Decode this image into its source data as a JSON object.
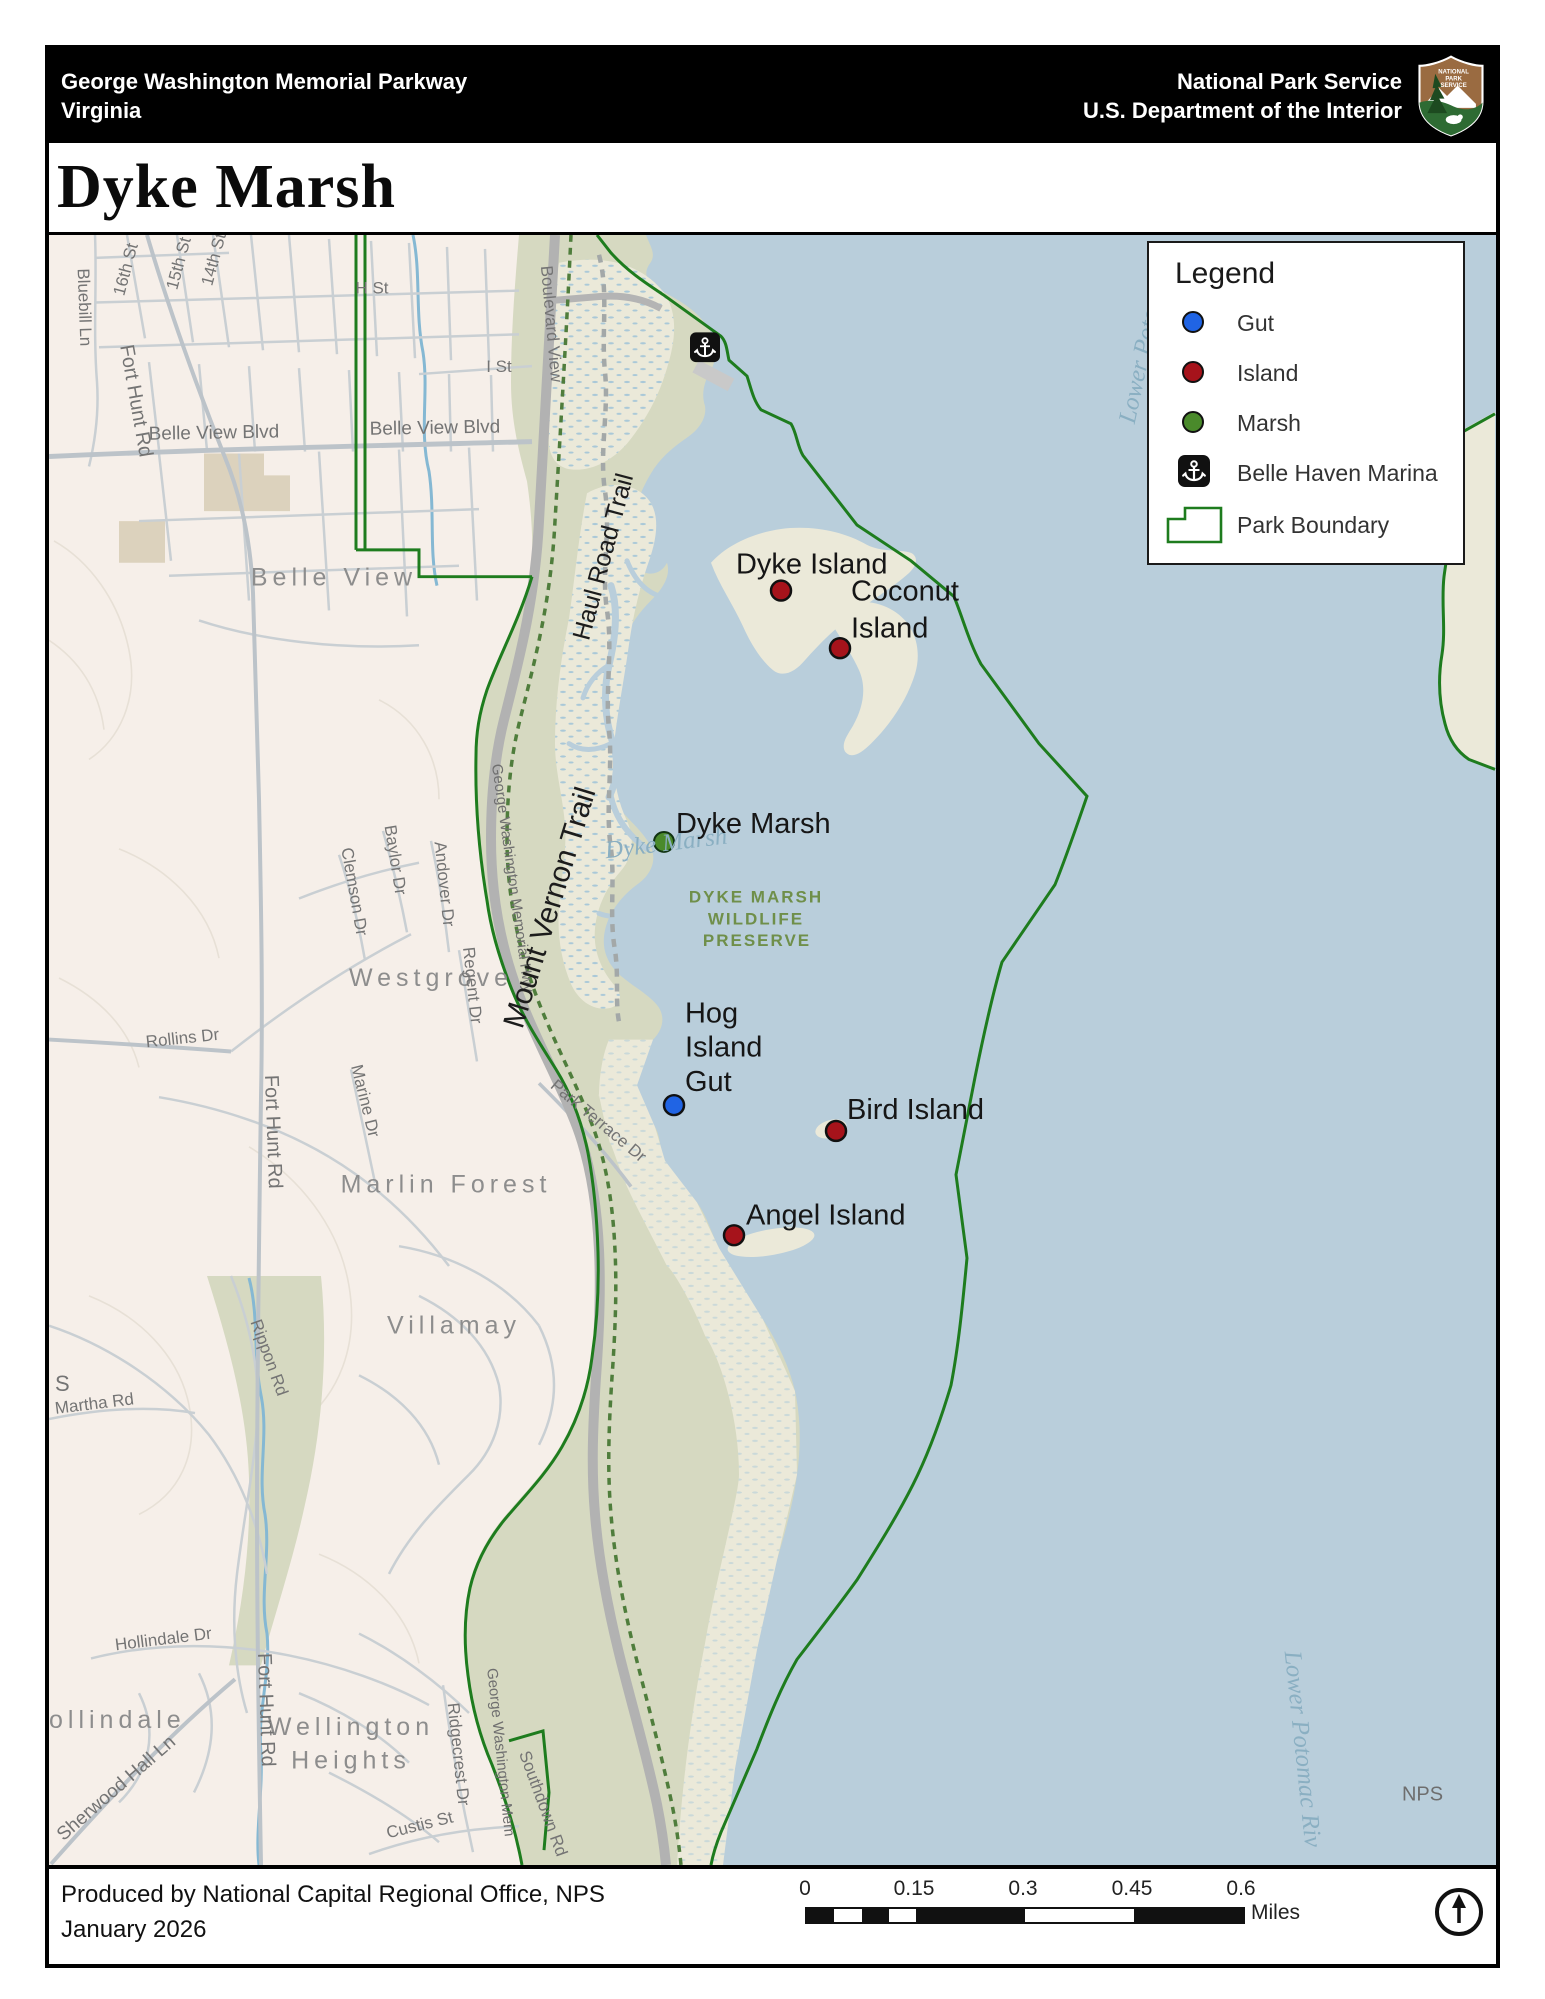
{
  "header": {
    "park": "George Washington Memorial Parkway",
    "state": "Virginia",
    "agency": "National Park Service",
    "department": "U.S. Department of the Interior",
    "logo_text": {
      "l1": "NATIONAL",
      "l2": "PARK",
      "l3": "SERVICE"
    }
  },
  "title": "Dyke Marsh",
  "legend": {
    "title": "Legend",
    "items": [
      {
        "label": "Gut",
        "color": "#2064E4"
      },
      {
        "label": "Island",
        "color": "#A6131B"
      },
      {
        "label": "Marsh",
        "color": "#4A8A2B"
      },
      {
        "label": "Belle Haven Marina",
        "color": "#111111"
      },
      {
        "label": "Park Boundary",
        "color": "#1E7C1E"
      }
    ]
  },
  "map": {
    "features": {
      "dyke_island": "Dyke Island",
      "coconut1": "Coconut",
      "coconut2": "Island",
      "dyke_marsh": "Dyke Marsh",
      "hog1": "Hog",
      "hog2": "Island",
      "hog3": "Gut",
      "bird_island": "Bird Island",
      "angel_island": "Angel Island"
    },
    "preserve": {
      "l1": "DYKE MARSH",
      "l2": "WILDLIFE",
      "l3": "PRESERVE"
    },
    "water": {
      "lower_potomac": "Lower Potomac",
      "dyke_marsh": "Dyke Marsh",
      "lower_potomac_riv": "Lower Potomac Riv"
    },
    "neighborhoods": {
      "belle_view": "Belle View",
      "westgrove": "Westgrove",
      "marlin_forest": "Marlin Forest",
      "villamay": "Villamay",
      "hollindale": "ollindale",
      "wellington": "Wellington",
      "heights": "Heights"
    },
    "streets": {
      "st16": "16th St",
      "st15": "15th St",
      "st14": "14th St",
      "bluebill": "Bluebill Ln",
      "fort_hunt_1": "Fort Hunt Rd",
      "fort_hunt_2": "Fort Hunt Rd",
      "fort_hunt_3": "Fort Hunt Rd",
      "belle_view_blvd_1": "Belle View Blvd",
      "belle_view_blvd_2": "Belle View Blvd",
      "h_st": "H St",
      "i_st": "I St",
      "boulevard_view": "Boulevard View",
      "rollins": "Rollins Dr",
      "clemson": "Clemson Dr",
      "baylor": "Baylor Dr",
      "andover": "Andover Dr",
      "regent": "Regent Dr",
      "marine": "Marine Dr",
      "park_terrace": "Park Terrace Dr",
      "martha": "Martha Rd",
      "s_frag": "S",
      "rippon": "Rippon Rd",
      "hollindale_dr": "Hollindale Dr",
      "sherwood": "Sherwood Hall Ln",
      "ridgecrest": "Ridgecrest Dr",
      "custis": "Custis St",
      "southdown": "Southdown Rd",
      "gw_hwy": "George Washington Memorial Hwy",
      "gw_hwy_2": "George Washington Mem"
    },
    "trails": {
      "haul_road": "Haul Road Trail",
      "mount_vernon": "Mount Vernon Trail"
    },
    "credit": "NPS",
    "colors": {
      "water": "#B9CEDB",
      "urban_land": "#F6EFE9",
      "park_land": "#D6D9C1",
      "marsh_land": "#EBE9D9",
      "park_boundary": "#1E7C1E",
      "gut_marker": "#2064E4",
      "island_marker": "#A6131B",
      "marsh_marker": "#4A8A2B"
    }
  },
  "footer": {
    "credit_line1": "Produced by National Capital Regional Office, NPS",
    "credit_line2": "January 2026",
    "scale": {
      "t0": "0",
      "t1": "0.15",
      "t2": "0.3",
      "t3": "0.45",
      "t4": "0.6",
      "unit": "Miles"
    }
  }
}
